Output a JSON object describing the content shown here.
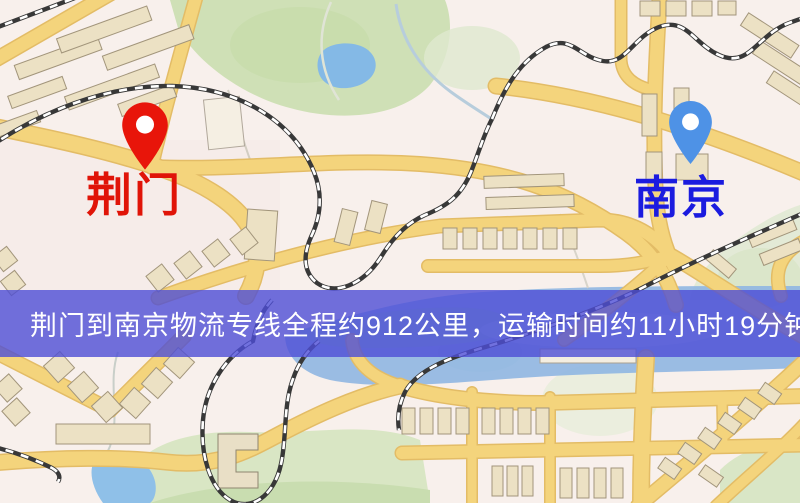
{
  "banner": {
    "text": "荆门到南京物流专线全程约912公里，运输时间约11小时19分钟.",
    "background_color": "#4d4dd6",
    "text_color": "#ffffff"
  },
  "markers": {
    "origin": {
      "label": "荆门",
      "pin_icon": "red-map-pin-icon",
      "pin_color": "#e8150a",
      "label_color": "#e01408"
    },
    "destination": {
      "label": "南京",
      "pin_icon": "blue-map-pin-icon",
      "pin_color": "#4e92e6",
      "label_color": "#1b1bdf"
    }
  },
  "route": {
    "origin_city": "荆门",
    "destination_city": "南京",
    "distance_text": "约912公里",
    "duration_text": "约11小时19分钟"
  },
  "map_palette": {
    "background": "#f8f0ec",
    "road_fill": "#f4d47c",
    "road_casing": "#e3bc66",
    "park_green": "#d2e1ba",
    "water_blue": "#8fb6e2",
    "building_tan": "#ece1c4",
    "railway_black": "#383838"
  }
}
